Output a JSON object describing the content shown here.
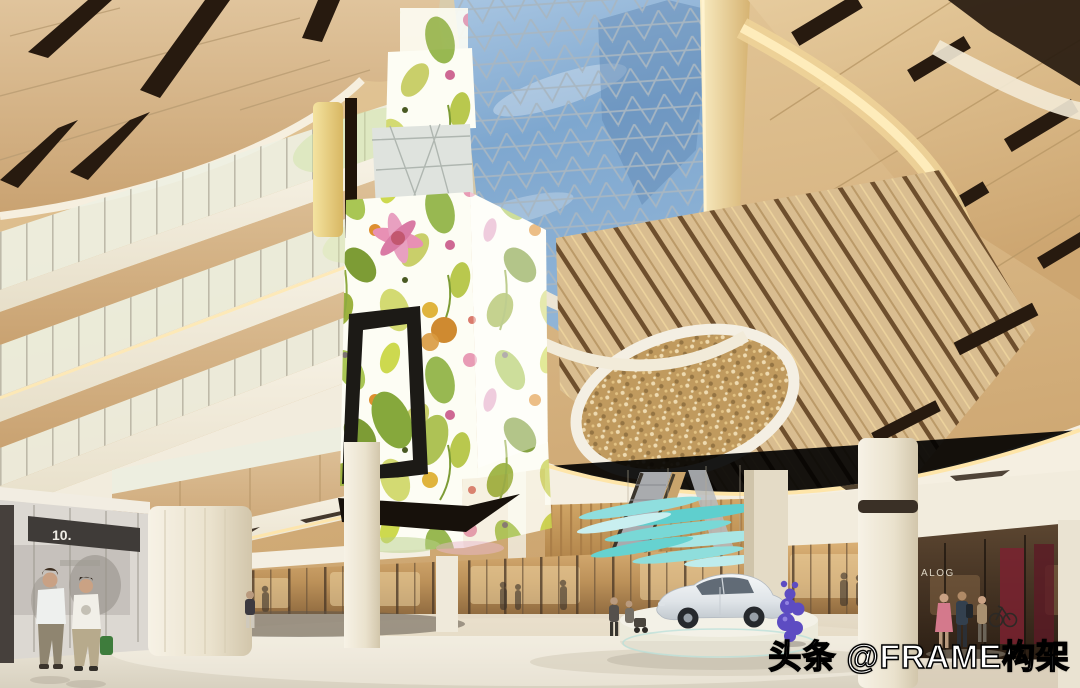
{
  "scene": {
    "description_label": "mall-atrium-rendering",
    "watermark": {
      "text": "头条 @FRAME构架",
      "fill": "#ffffff",
      "outline": "#000000"
    },
    "storefronts": {
      "left_sign": "10.",
      "right_sign": "ALOG"
    }
  },
  "palette": {
    "sky_top": "#a9c6e2",
    "sky_deep": "#6e97c2",
    "lattice": "#a7b6c2",
    "wood": "#d7b88a",
    "wood_shadow": "#b99565",
    "slot": "#271a0f",
    "fascia": "#f6f0e2",
    "cove": "#ffe8b0",
    "amber_wall": "#c89a5e",
    "teal_art": "#68d0cf",
    "purple": "#5d4cc2",
    "floor": "#e9e3d4",
    "inlay": "#5e564a",
    "store_glow": "#c59a62",
    "store_dark": "#382a1c",
    "car_silver": "#e9eced",
    "print_green": "#a9c654",
    "print_pink": "#e48fb2",
    "print_orange": "#d98f2e"
  }
}
